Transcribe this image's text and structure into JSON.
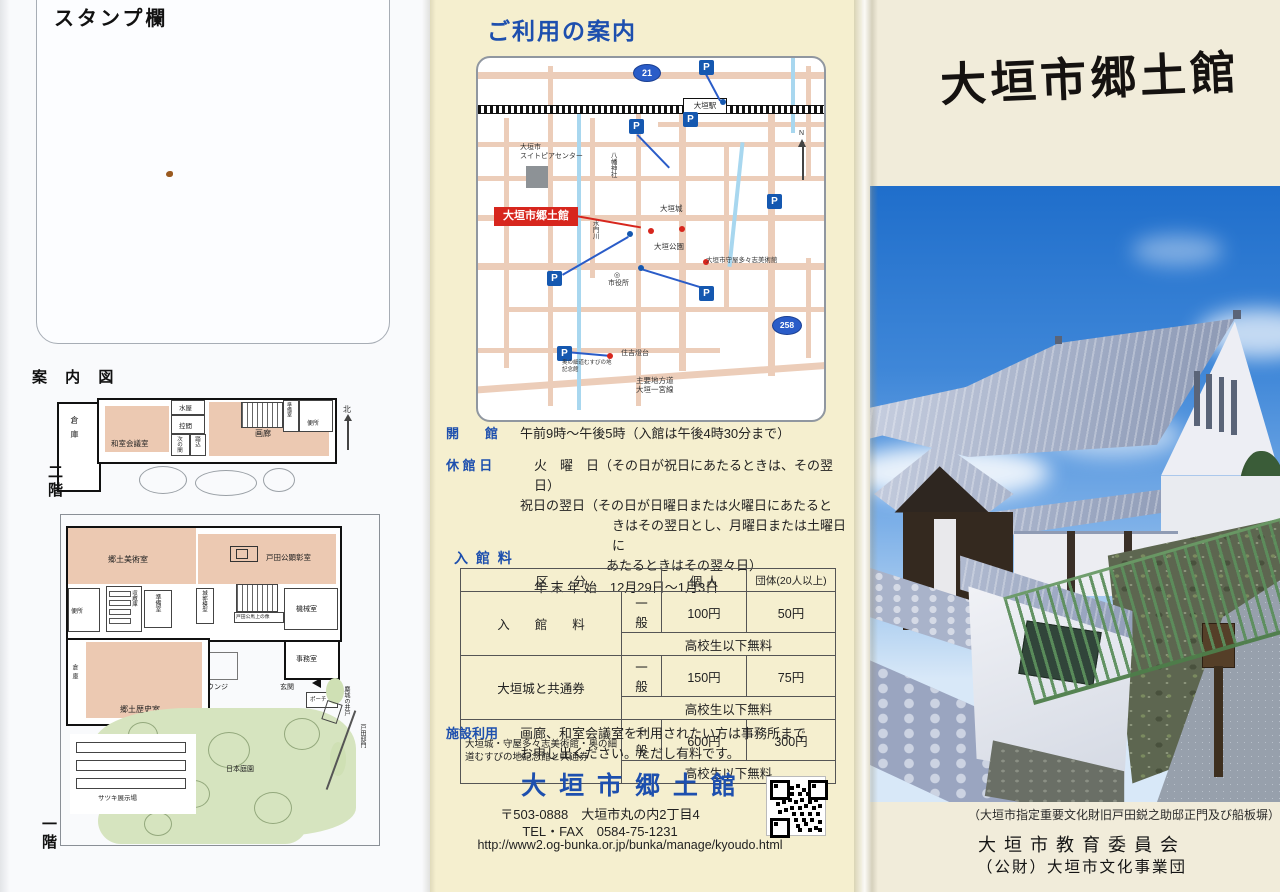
{
  "left": {
    "stamp_label": "スタンプ欄",
    "guide_title": "案 内 図",
    "floor2": {
      "label": "二階",
      "compass": "北",
      "rooms": {
        "soko": "倉庫",
        "washitsu": "和室会議室",
        "mizuya": "水屋",
        "hikae": "控間",
        "tsugi": "次の間",
        "fumikomi": "踏込",
        "garo": "画廊",
        "junbi": "準備室",
        "benjo": "便所"
      }
    },
    "floor1": {
      "label": "一階",
      "rooms": {
        "bijutsu": "郷土美術室",
        "kensho": "戸田公顕彰室",
        "benjo": "便所",
        "shuzo": "収蔵庫",
        "junbi": "準備室",
        "mokei": "城郭模型",
        "statue": "戸田公馬上の像",
        "kikai": "機械室",
        "jimu": "事務室",
        "genkan": "玄関",
        "porch": "ポーチ",
        "lounge": "ラウンジ",
        "rekishi": "郷土歴史室",
        "soko": "倉庫",
        "garden": "日本庭園",
        "satsuki": "サツキ展示場",
        "ido": "麋城の井戸",
        "mon": "戸田邸門"
      }
    }
  },
  "mid": {
    "title": "ご利用の案内",
    "map": {
      "parking": "P",
      "north": "N",
      "route21": "21",
      "route258": "258",
      "station": "大垣駅",
      "suitopia1": "大垣市",
      "suitopia2": "スイトピアセンター",
      "kyodokan": "大垣市郷土館",
      "castle": "大垣城",
      "park": "大垣公園",
      "art_museum": "大垣市守屋多々志美術館",
      "city_hall": "市役所",
      "city_hall_mark": "◎",
      "hachiman": "八幡神社",
      "suimon": "水門川",
      "lighthouse": "住吉燈台",
      "okuno1": "奥の細道むすびの地",
      "okuno2": "記念館",
      "road1": "主要地方道",
      "road2": "大垣一宮線"
    },
    "hours": {
      "open_label": "開　　館",
      "open_text": "午前9時～午後5時（入館は午後4時30分まで）",
      "closed_label": "休 館 日",
      "closed_lines": [
        "火　曜　日（その日が祝日にあたるときは、その翌日）",
        "祝日の翌日（その日が日曜日または火曜日にあたると",
        "きはその翌日とし、月曜日または土曜日に",
        "あたるときはその翌々日）",
        "年 末 年 始　12月29日～1月3日"
      ]
    },
    "fees": {
      "title": "入 館 料",
      "col_category": "区　　分",
      "col_individual": "個 人",
      "col_group": "団体(20人以上)",
      "rows": [
        {
          "category": "入　　館　　料",
          "type": "一　般",
          "individual": "100円",
          "group": "50円",
          "free": "高校生以下無料"
        },
        {
          "category": "大垣城と共通券",
          "type": "一　般",
          "individual": "150円",
          "group": "75円",
          "free": "高校生以下無料"
        },
        {
          "category": "大垣城・守屋多々志美術館・奥の細道むすびの地記念館と共通券",
          "type": "一　般",
          "individual": "600円",
          "group": "300円",
          "free": "高校生以下無料"
        }
      ]
    },
    "facility": {
      "label": "施設利用",
      "line1": "画廊、和室会議室を利用されたい方は事務所まで",
      "line2": "お申し出ください。ただし有料です。"
    },
    "contact": {
      "name": "大 垣 市 郷 土 館",
      "postal": "〒503-0888　大垣市丸の内2丁目4",
      "tel": "TEL・FAX　0584-75-1231",
      "url": "http://www2.og-bunka.or.jp/bunka/manage/kyoudo.html"
    }
  },
  "right": {
    "title": "大垣市郷土館",
    "caption": "（大垣市指定重要文化財旧戸田鋭之助邸正門及び船板塀）",
    "org1": "大垣市教育委員会",
    "org2": "（公財）大垣市文化事業団"
  },
  "colors": {
    "blue_text": "#1d4fae",
    "map_road": "#eccdb9",
    "map_river": "#a8d7ef",
    "red_accent": "#d7261d",
    "parking_blue": "#1558b0",
    "plan_pink": "#ecc9b2",
    "plan_green": "#d6e4bf"
  }
}
